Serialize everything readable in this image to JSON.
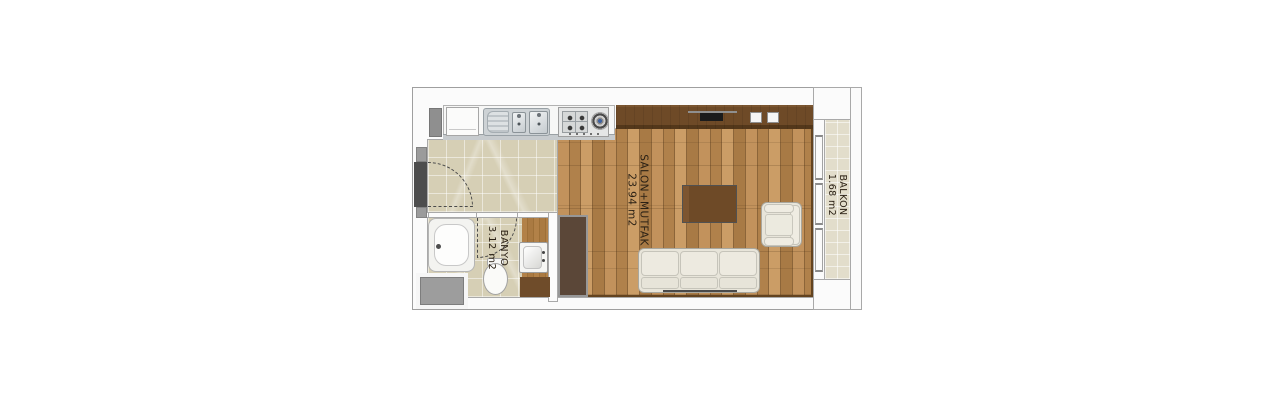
{
  "rooms": [
    {
      "id": "salon-mutfak",
      "label": "SALON+MUTFAK",
      "area": "23.94 m2"
    },
    {
      "id": "banyo",
      "label": "BANYO",
      "area": "3.12 m2"
    },
    {
      "id": "balkon",
      "label": "BALKON",
      "area": "1.68 m2"
    }
  ],
  "colors": {
    "wood-a": "#c2925c",
    "wood-b": "#b0814b",
    "wood-c": "#cb9d66",
    "wood-d": "#a87a45",
    "wood-line": "#8c6539",
    "tile": "#d6cfb5",
    "balcony-tile": "#e2ddcb",
    "dark-wood": "#6e4a27",
    "closet": "#5b4738",
    "wall": "#fbfbfb",
    "wall-line": "#a9a9a9",
    "text": "#2b2115",
    "steel": "#cdd2d5",
    "cream": "#e8e5da",
    "gray-block": "#9d9d9d",
    "door-dark": "#4d4d4d"
  }
}
